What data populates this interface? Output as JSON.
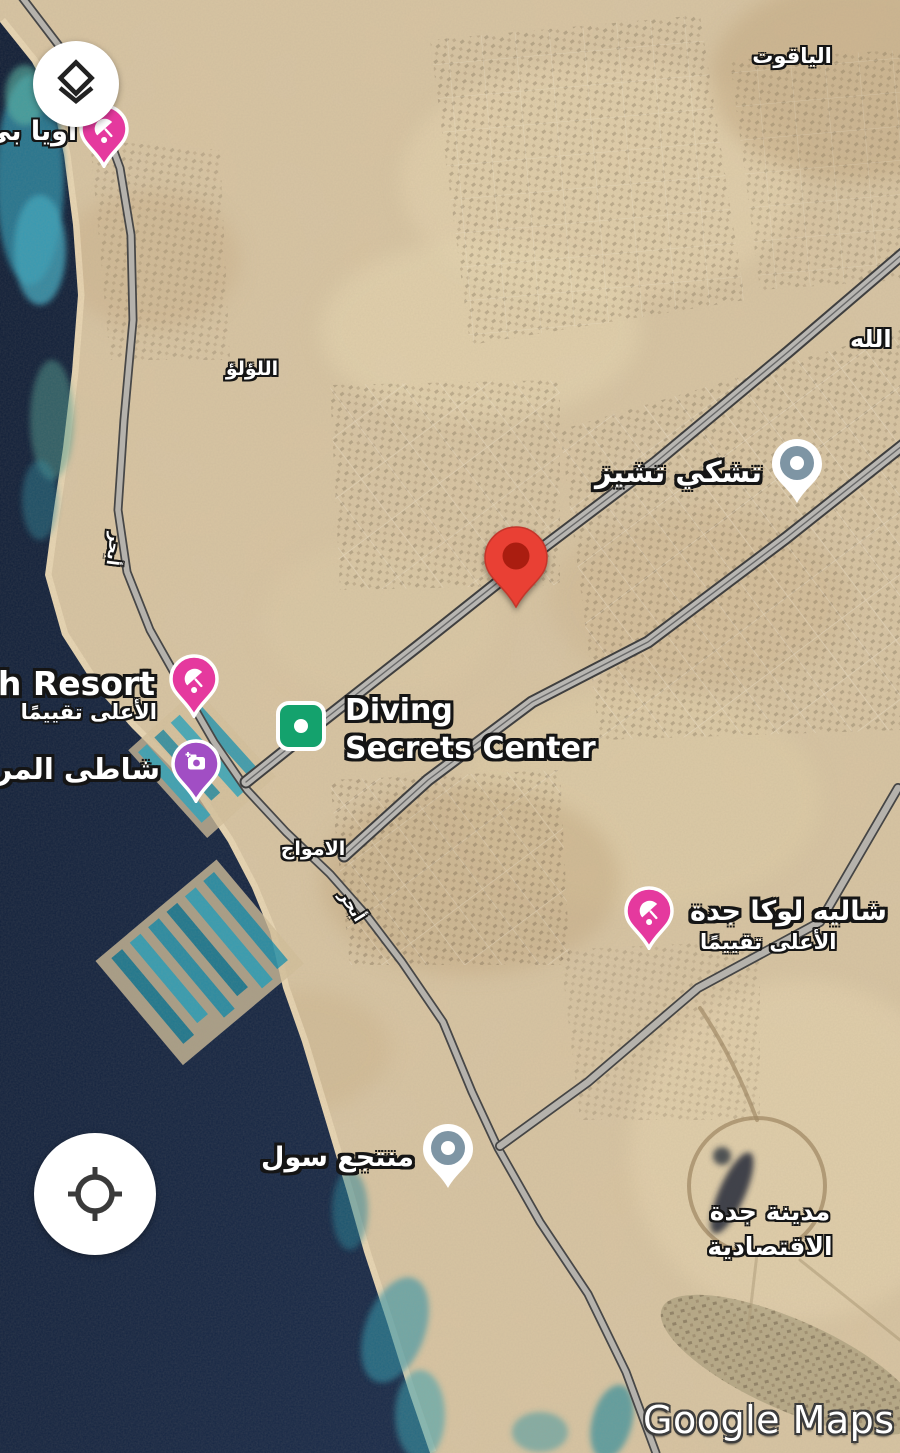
{
  "app": {
    "watermark": "Google Maps"
  },
  "controls": {
    "layers_button": {
      "icon": "layers-icon"
    },
    "my_location_button": {
      "icon": "my-location-icon"
    }
  },
  "destination_pin": {
    "type": "red-pin"
  },
  "pois": {
    "oia_beach": {
      "label": "اويا بي",
      "marker": "beach-umbrella-pink"
    },
    "chuck_e_cheese": {
      "label": "تشكي تشيز",
      "marker": "generic-gray-blue"
    },
    "beach_resort": {
      "label": "ach Resort",
      "sub": "الأعلى تقييمًا",
      "marker": "beach-umbrella-pink"
    },
    "coral_beach": {
      "label": "شاطى المرجا",
      "marker": "photo-spot-purple"
    },
    "diving_secrets": {
      "line1": "Diving",
      "line2": "Secrets Center",
      "marker": "green-square"
    },
    "chalet_luca": {
      "label": "شاليه لوكا جدة",
      "sub": "الأعلى تقييمًا",
      "marker": "beach-umbrella-pink"
    },
    "sol_resort": {
      "label": "منتجع سول",
      "marker": "generic-gray-blue"
    }
  },
  "area_labels": {
    "yaqut": "الياقوت",
    "lulu": "اللؤلؤ",
    "allah_partial": "الله",
    "amwaj": "الامواج",
    "obhur_road_1": "أبحر",
    "obhur_road_2": "أبحر",
    "jec_line1": "مدينة جدة",
    "jec_line2": "الاقتصادية"
  },
  "colors": {
    "sea": "#13223c",
    "reef_teal": "#2f98ae",
    "land_sand": "#d9c5a2",
    "road_gray": "#b8b6b2",
    "pin_red": "#ea4335",
    "marker_pink": "#e5399e",
    "marker_purple": "#a14ec4",
    "marker_gray_blue": "#7e95a4",
    "marker_green": "#14a26d"
  }
}
